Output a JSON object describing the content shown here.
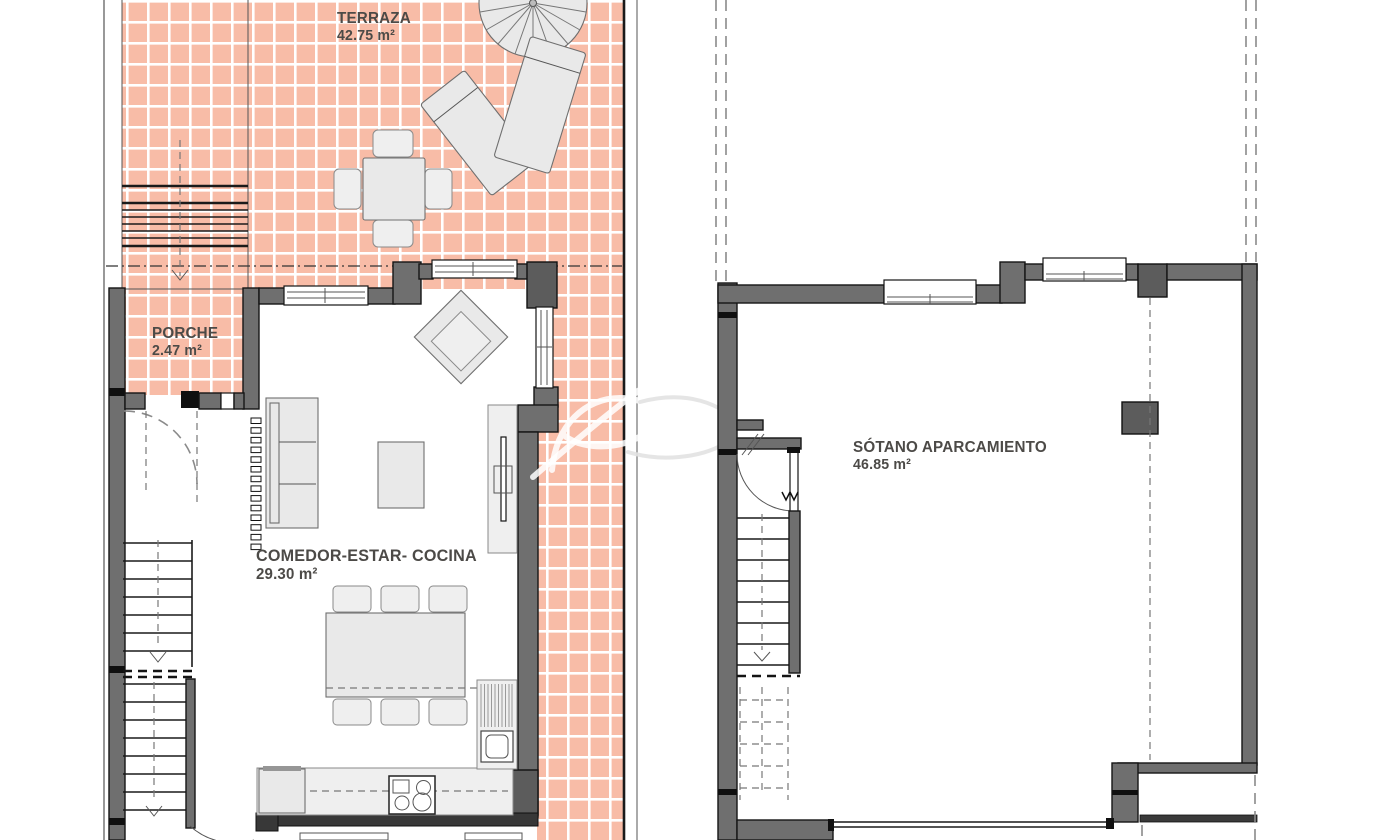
{
  "title": "Residential floor plans",
  "colors": {
    "tile": "#f8bca7",
    "grout": "#ffffff",
    "wall": "#6f6f6f",
    "walldark": "#5c5c5c",
    "furn": "#e9e9e9",
    "label": "#4c4a47"
  },
  "rooms": [
    {
      "id": "terraza",
      "name": "TERRAZA",
      "area": "42.75 m²"
    },
    {
      "id": "porche",
      "name": "PORCHE",
      "area": "2.47 m²"
    },
    {
      "id": "comedor-estar-cocina",
      "name": "COMEDOR-ESTAR- COCINA",
      "area": "29.30 m²"
    },
    {
      "id": "sotano-aparcamiento",
      "name": "SÓTANO APARCAMIENTO",
      "area": "46.85 m²"
    }
  ]
}
